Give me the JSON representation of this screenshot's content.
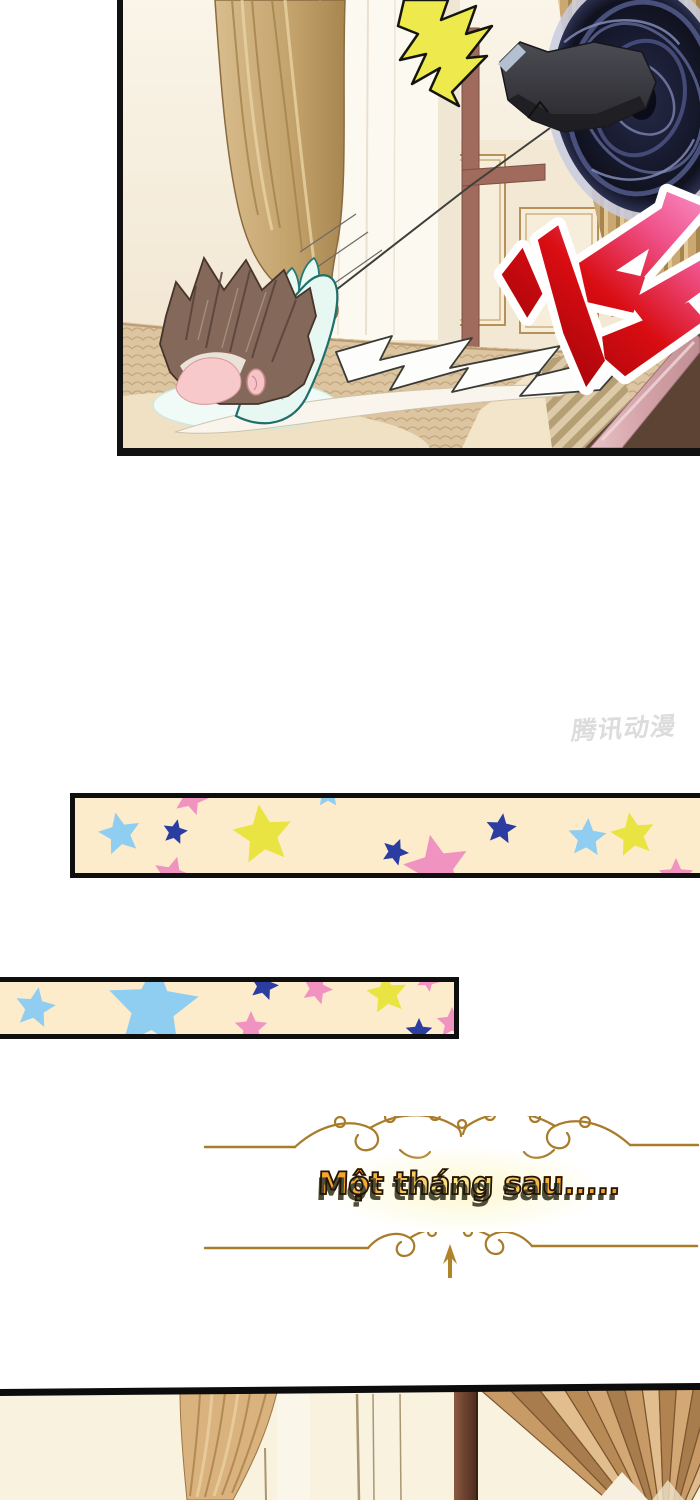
{
  "watermark": {
    "text": "腾讯动漫",
    "color": "#d6d6d6"
  },
  "panel_top": {
    "sfx_text": "嗖",
    "palette": {
      "wall_cream": "#f8f2e4",
      "curtain_gold": "#c9a873",
      "sheer_white": "#fcf9f1",
      "portal_dark": "#14172c",
      "portal_swirl": "#5a6396",
      "boot_gray": "#3a3a40",
      "shock_yellow": "#eeea4e",
      "sfx_red": "#d90d12",
      "sfx_pink": "#f78cc4",
      "sfx_outline": "#ffffff",
      "hair_brown": "#84695a",
      "skin_pink": "#f8c9cb",
      "outfit_mint": "#e7f7f1",
      "outfit_line_teal": "#1f6f6a",
      "bed_tan": "#dcc5a0",
      "sheet_cream": "#f0e3c6",
      "rail_rose": "#d8aab0",
      "wood_brown": "#5c4333",
      "frame_red_brown": "#a06a5c",
      "panel_frame_gold": "#b6925a",
      "border_black": "#111111"
    }
  },
  "star_banners": {
    "background": "#fceccb",
    "border": "#0f0f0f",
    "star_colors": {
      "light_blue": "#8fcdf1",
      "dark_blue": "#2b3da0",
      "yellow": "#e9e441",
      "pink": "#f193c1"
    },
    "banner1": {
      "stars": [
        {
          "color": "light_blue",
          "x": 45,
          "y": 36,
          "r": 22,
          "rot": -12
        },
        {
          "color": "dark_blue",
          "x": 100,
          "y": 34,
          "r": 13,
          "rot": 12
        },
        {
          "color": "pink",
          "x": 116,
          "y": 0,
          "r": 18,
          "rot": 18
        },
        {
          "color": "yellow",
          "x": 188,
          "y": 37,
          "r": 31,
          "rot": -8
        },
        {
          "color": "light_blue",
          "x": 253,
          "y": -4,
          "r": 14,
          "rot": 0
        },
        {
          "color": "pink",
          "x": 97,
          "y": 78,
          "r": 20,
          "rot": 15
        },
        {
          "color": "dark_blue",
          "x": 320,
          "y": 54,
          "r": 14,
          "rot": 22
        },
        {
          "color": "pink",
          "x": 362,
          "y": 70,
          "r": 34,
          "rot": -12
        },
        {
          "color": "dark_blue",
          "x": 426,
          "y": 31,
          "r": 16,
          "rot": 8
        },
        {
          "color": "light_blue",
          "x": 512,
          "y": 40,
          "r": 20,
          "rot": 4
        },
        {
          "color": "yellow",
          "x": 558,
          "y": 37,
          "r": 23,
          "rot": -10
        },
        {
          "color": "pink",
          "x": 601,
          "y": 78,
          "r": 18,
          "rot": 0
        }
      ]
    },
    "banner2": {
      "stars": [
        {
          "color": "light_blue",
          "x": 35,
          "y": 26,
          "r": 21,
          "rot": 10
        },
        {
          "color": "light_blue",
          "x": 153,
          "y": 26,
          "r": 47,
          "rot": 4
        },
        {
          "color": "dark_blue",
          "x": 264,
          "y": 4,
          "r": 15,
          "rot": 15
        },
        {
          "color": "pink",
          "x": 251,
          "y": 46,
          "r": 17,
          "rot": 0
        },
        {
          "color": "pink",
          "x": 317,
          "y": 7,
          "r": 16,
          "rot": 20
        },
        {
          "color": "yellow",
          "x": 387,
          "y": 12,
          "r": 21,
          "rot": -8
        },
        {
          "color": "dark_blue",
          "x": 419,
          "y": 50,
          "r": 14,
          "rot": 0
        },
        {
          "color": "pink",
          "x": 452,
          "y": 41,
          "r": 16,
          "rot": 0
        },
        {
          "color": "pink",
          "x": 428,
          "y": -2,
          "r": 12,
          "rot": 28
        }
      ]
    }
  },
  "caption": {
    "text": "Một tháng sau.....",
    "fill_orange": "#f2a82e",
    "fill_light": "#fce98e",
    "outline": "#221406",
    "shadow": "#4e4e38",
    "glow": "#fdf7cd",
    "divider_gold": "#a87c2a"
  },
  "panel_bottom": {
    "palette": {
      "wall_cream": "#f9f2df",
      "curtain_gold": "#d9b27e",
      "fan_light": "#e2be8e",
      "fan_mid": "#c89a66",
      "fan_dark": "#a87c4c",
      "post_brown": "#7a4a34",
      "border_black": "#0c0c0c"
    }
  }
}
